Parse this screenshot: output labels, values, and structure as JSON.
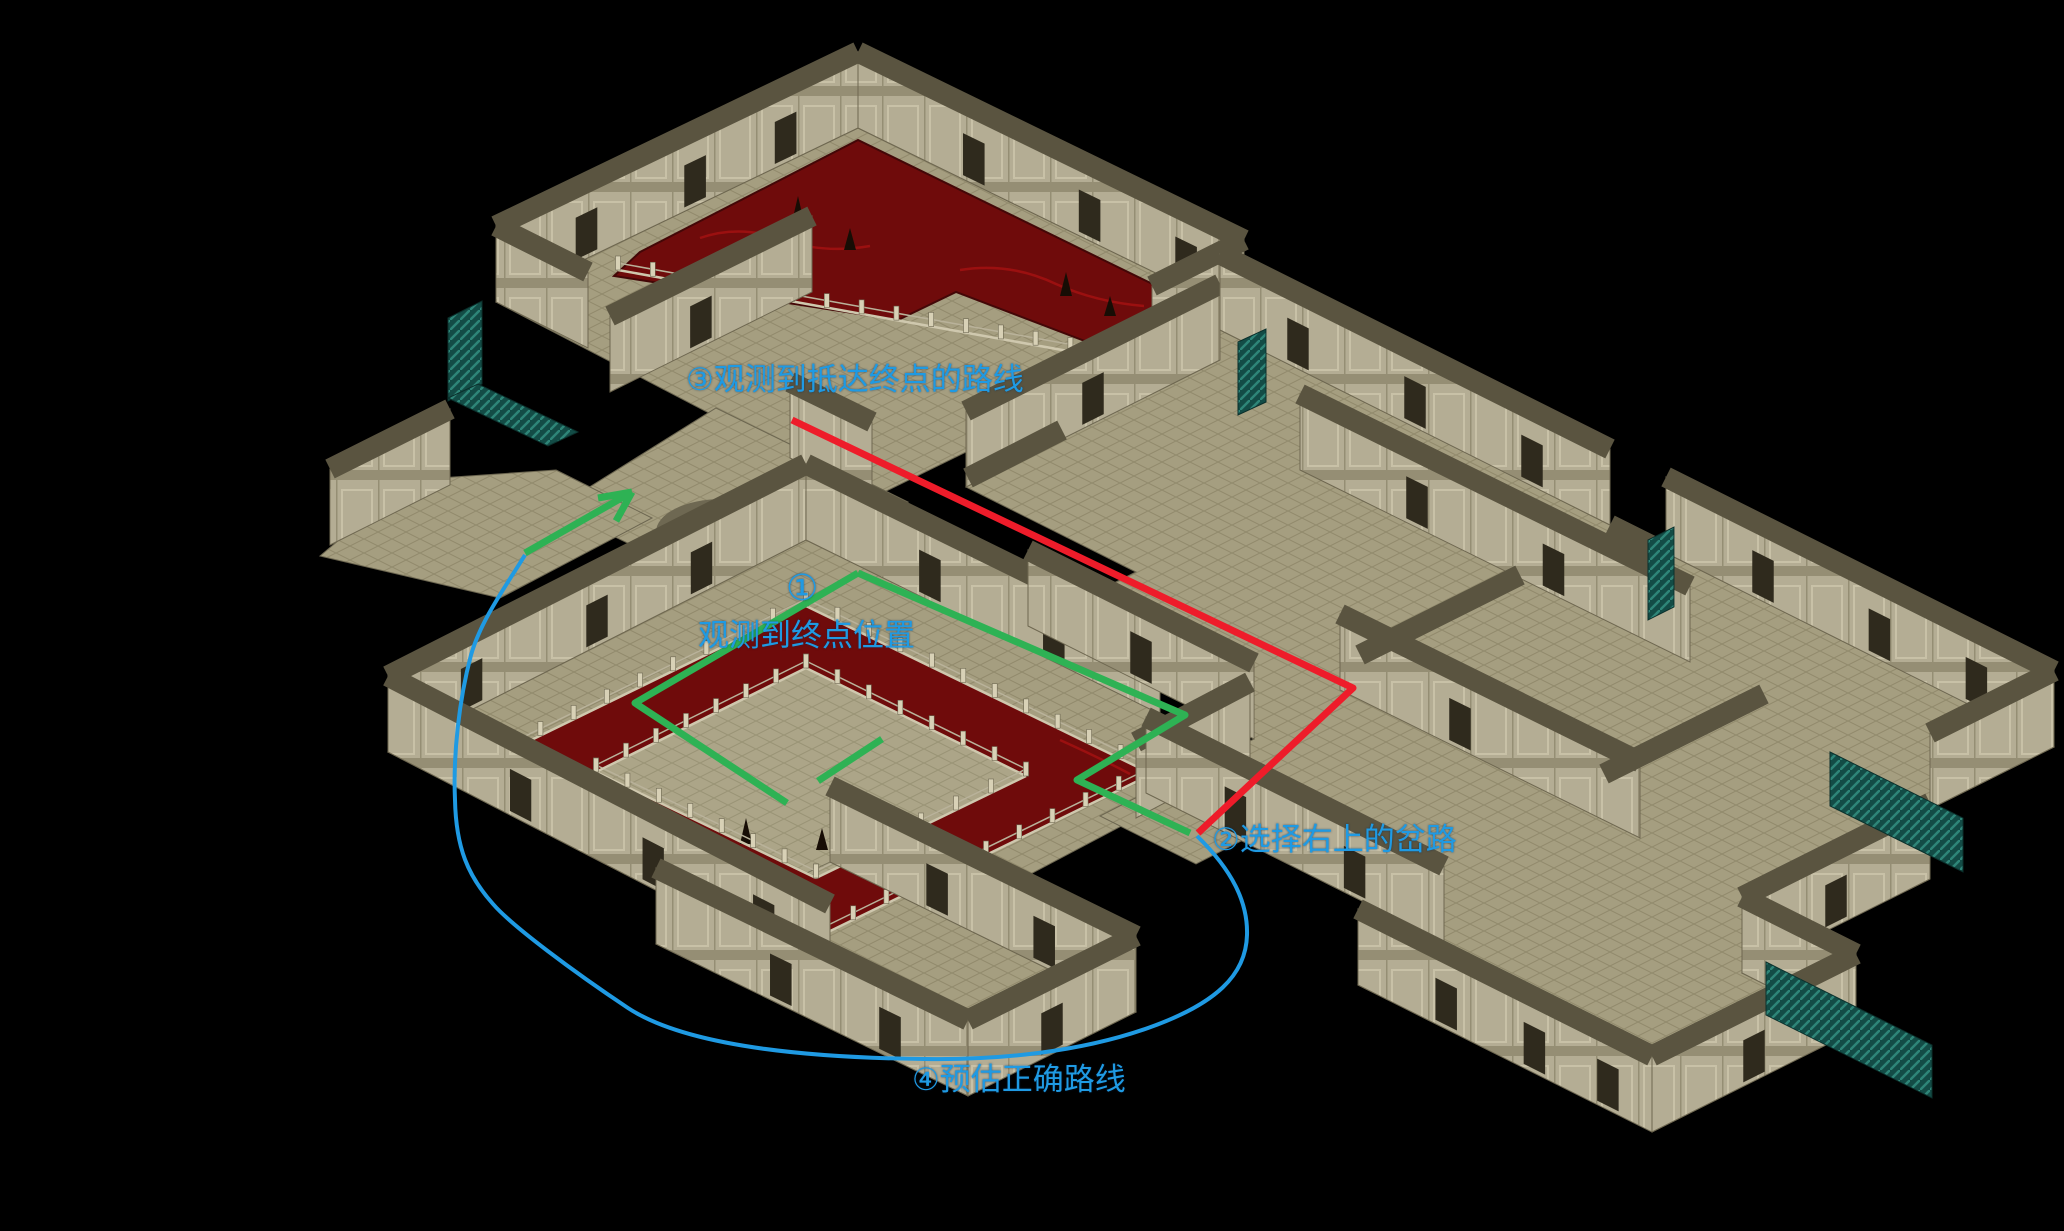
{
  "app": {
    "title": "isometric dungeon map with route annotations"
  },
  "annotations": {
    "text_color": "#1f9ae3",
    "labels": [
      {
        "id": "step3",
        "text": "③观测到抵达终点的路线",
        "x": 686,
        "y": 364,
        "size": 31
      },
      {
        "id": "step1_num",
        "text": "①",
        "x": 786,
        "y": 570,
        "size": 36
      },
      {
        "id": "step1",
        "text": "观测到终点位置",
        "x": 698,
        "y": 620,
        "size": 31
      },
      {
        "id": "step2",
        "text": "②选择右上的岔路",
        "x": 1212,
        "y": 824,
        "size": 31
      },
      {
        "id": "step4",
        "text": "④预估正确路线",
        "x": 912,
        "y": 1064,
        "size": 31
      }
    ],
    "red_route": {
      "color": "#ee1c2a",
      "width": 7,
      "points": [
        [
          792,
          420
        ],
        [
          1353,
          688
        ],
        [
          1198,
          833
        ]
      ]
    },
    "green_route": {
      "color": "#2eb254",
      "width": 7,
      "segments": [
        [
          [
            858,
            573
          ],
          [
            1185,
            715
          ],
          [
            1077,
            780
          ],
          [
            1190,
            833
          ]
        ],
        [
          [
            858,
            573
          ],
          [
            635,
            703
          ],
          [
            787,
            803
          ]
        ],
        [
          [
            882,
            739
          ],
          [
            818,
            781
          ]
        ],
        [
          [
            525,
            553
          ],
          [
            625,
            496
          ]
        ],
        [
          [
            632,
            492
          ],
          [
            598,
            498
          ]
        ],
        [
          [
            632,
            492
          ],
          [
            616,
            521
          ]
        ]
      ]
    },
    "blue_route": {
      "color": "#1f9ae3",
      "width": 4,
      "path": "M1197,836 C1232,870 1248,902 1247,935 C1246,975 1216,1004 1148,1028 C1080,1052 1000,1060 925,1059 C830,1058 692,1050 628,1008 C574,972 512,926 493,904 C468,876 456,848 455,800 C453,755 459,700 471,655 C481,620 506,586 525,555"
    }
  },
  "scene": {
    "colors": {
      "bg": "#000000",
      "floor": "#a59e80",
      "grid": "#918a6c",
      "wall_face": "#b4ad94",
      "wall_top": "#5a5440",
      "panel_light": "#c8c1a7",
      "panel_dark": "#958e74",
      "door": "#2f2a1d",
      "pool": "#6f0b0b",
      "pool_swirl": "#a31212",
      "pool_edge": "#430707",
      "teal": "#134c46",
      "teal_stripe": "#2e8578",
      "rail": "#cfc8ae",
      "post": "#d8d1b6",
      "post_edge": "#6e6852",
      "spike": "#170d05",
      "yin_dark": "#6e6852",
      "yin_light": "#c9c3ab"
    },
    "wall_height": 76,
    "floors": [
      {
        "pts": [
          [
            858,
            128
          ],
          [
            1244,
            316
          ],
          [
            872,
            498
          ],
          [
            496,
            302
          ]
        ]
      },
      {
        "pts": [
          [
            716,
            408
          ],
          [
            908,
            502
          ],
          [
            748,
            602
          ],
          [
            556,
            508
          ]
        ]
      },
      {
        "pts": [
          [
            556,
            470
          ],
          [
            652,
            518
          ],
          [
            500,
            598
          ],
          [
            320,
            556
          ],
          [
            410,
            480
          ]
        ]
      },
      {
        "pts": [
          [
            806,
            540
          ],
          [
            1250,
            758
          ],
          [
            830,
            980
          ],
          [
            388,
            752
          ]
        ]
      },
      {
        "pts": [
          [
            1194,
            768
          ],
          [
            1290,
            816
          ],
          [
            1196,
            864
          ],
          [
            1100,
            816
          ]
        ]
      },
      {
        "pts": [
          [
            830,
            862
          ],
          [
            1136,
            1012
          ],
          [
            968,
            1096
          ],
          [
            656,
            944
          ]
        ]
      },
      {
        "pts": [
          [
            1220,
            330
          ],
          [
            1610,
            525
          ],
          [
            1666,
            553
          ],
          [
            2054,
            747
          ],
          [
            1930,
            809
          ],
          [
            1930,
            879
          ],
          [
            1742,
            973
          ],
          [
            1856,
            1030
          ],
          [
            1652,
            1132
          ],
          [
            1358,
            985
          ],
          [
            1444,
            942
          ],
          [
            1146,
            793
          ],
          [
            1254,
            739
          ],
          [
            1028,
            626
          ],
          [
            1136,
            572
          ],
          [
            966,
            487
          ],
          [
            1220,
            360
          ]
        ]
      }
    ],
    "floor_overlays": [
      {
        "pts": [
          [
            806,
            668
          ],
          [
            1026,
            776
          ],
          [
            816,
            878
          ],
          [
            596,
            772
          ]
        ],
        "fill": "rgba(238,232,205,0.10)"
      }
    ],
    "pools": [
      {
        "d": "M640,252 L858,140 L1226,320 L1140,362 L956,292 L898,320 L614,276 Z"
      },
      {
        "d": "M806,606 L1152,774 L820,936 L474,768 Z M806,668 L1026,776 L816,878 L596,772 Z"
      }
    ],
    "pool_swirls": [
      "M700,238 q40,-14 84,2 q40,14 86,6",
      "M960,270 q50,-8 96,14 q40,18 88,22",
      "M520,760 q60,26 120,40",
      "M880,880 q60,10 120,-14",
      "M1060,740 q40,18 70,34"
    ],
    "spikes": [
      [
        798,
        222,
        26
      ],
      [
        850,
        250,
        22
      ],
      [
        1066,
        296,
        24
      ],
      [
        1110,
        316,
        20
      ],
      [
        746,
        844,
        26
      ],
      [
        822,
        850,
        22
      ]
    ],
    "fences": [
      {
        "a": [
          618,
          270
        ],
        "b": [
          1140,
          364
        ]
      },
      {
        "a": [
          806,
          606
        ],
        "b": [
          1152,
          774
        ]
      },
      {
        "a": [
          1152,
          774
        ],
        "b": [
          820,
          936
        ]
      },
      {
        "a": [
          820,
          936
        ],
        "b": [
          474,
          768
        ]
      },
      {
        "a": [
          474,
          768
        ],
        "b": [
          806,
          606
        ]
      },
      {
        "a": [
          806,
          668
        ],
        "b": [
          1026,
          776
        ]
      },
      {
        "a": [
          1026,
          776
        ],
        "b": [
          816,
          878
        ]
      },
      {
        "a": [
          816,
          878
        ],
        "b": [
          596,
          772
        ]
      },
      {
        "a": [
          596,
          772
        ],
        "b": [
          806,
          668
        ]
      }
    ],
    "walls": [
      {
        "a": [
          496,
          302
        ],
        "b": [
          858,
          128
        ],
        "doors": [
          0.25,
          0.55,
          0.8
        ]
      },
      {
        "a": [
          858,
          128
        ],
        "b": [
          1244,
          316
        ],
        "doors": [
          0.3,
          0.6,
          0.85
        ]
      },
      {
        "a": [
          610,
          392
        ],
        "b": [
          812,
          292
        ],
        "doors": [
          0.45
        ]
      },
      {
        "a": [
          966,
          487
        ],
        "b": [
          1220,
          360
        ],
        "doors": [
          0.5
        ]
      },
      {
        "a": [
          1220,
          330
        ],
        "b": [
          1610,
          525
        ],
        "doors": [
          0.2,
          0.5,
          0.8
        ]
      },
      {
        "a": [
          1666,
          553
        ],
        "b": [
          2054,
          747
        ],
        "doors": [
          0.25,
          0.55,
          0.8
        ]
      },
      {
        "a": [
          388,
          752
        ],
        "b": [
          806,
          540
        ],
        "doors": [
          0.2,
          0.5,
          0.75
        ]
      },
      {
        "a": [
          806,
          540
        ],
        "b": [
          1160,
          714
        ],
        "doors": [
          0.35,
          0.7
        ]
      },
      {
        "a": [
          1028,
          626
        ],
        "b": [
          1254,
          739
        ],
        "doors": [
          0.5
        ]
      },
      {
        "a": [
          1300,
          470
        ],
        "b": [
          1690,
          662
        ],
        "doors": [
          0.3,
          0.65
        ]
      },
      {
        "a": [
          1340,
          690
        ],
        "b": [
          1640,
          838
        ],
        "doors": [
          0.4
        ]
      },
      {
        "a": [
          496,
          302
        ],
        "b": [
          588,
          348
        ],
        "doors": []
      },
      {
        "a": [
          790,
          458
        ],
        "b": [
          872,
          498
        ],
        "doors": []
      },
      {
        "a": [
          1244,
          316
        ],
        "b": [
          1152,
          362
        ],
        "doors": []
      },
      {
        "a": [
          330,
          545
        ],
        "b": [
          450,
          485
        ],
        "doors": []
      },
      {
        "a": [
          1146,
          793
        ],
        "b": [
          1444,
          942
        ],
        "doors": [
          0.3,
          0.7
        ]
      },
      {
        "a": [
          388,
          752
        ],
        "b": [
          830,
          980
        ],
        "doors": [
          0.3,
          0.6,
          0.85
        ]
      },
      {
        "a": [
          1136,
          818
        ],
        "b": [
          1250,
          758
        ],
        "doors": []
      },
      {
        "a": [
          830,
          862
        ],
        "b": [
          1136,
          1012
        ],
        "doors": [
          0.35,
          0.7
        ]
      },
      {
        "a": [
          656,
          944
        ],
        "b": [
          968,
          1096
        ],
        "doors": [
          0.4,
          0.75
        ]
      },
      {
        "a": [
          1136,
          1012
        ],
        "b": [
          968,
          1096
        ],
        "doors": [
          0.5
        ]
      },
      {
        "a": [
          1930,
          879
        ],
        "b": [
          1742,
          973
        ],
        "doors": [
          0.5
        ]
      },
      {
        "a": [
          2054,
          747
        ],
        "b": [
          1930,
          809
        ],
        "doors": []
      },
      {
        "a": [
          1358,
          985
        ],
        "b": [
          1652,
          1132
        ],
        "doors": [
          0.3,
          0.6,
          0.85
        ]
      },
      {
        "a": [
          1742,
          973
        ],
        "b": [
          1856,
          1030
        ],
        "doors": []
      },
      {
        "a": [
          1652,
          1132
        ],
        "b": [
          1856,
          1030
        ],
        "doors": [
          0.5
        ]
      }
    ],
    "rooflines": [
      [
        [
          1520,
          575
        ],
        [
          1360,
          655
        ]
      ],
      [
        [
          1764,
          694
        ],
        [
          1604,
          774
        ]
      ],
      [
        [
          1610,
          525
        ],
        [
          1666,
          553
        ]
      ],
      [
        [
          1062,
          430
        ],
        [
          968,
          478
        ]
      ]
    ],
    "teal_pieces": [
      [
        [
          448,
          318
        ],
        [
          482,
          301
        ],
        [
          482,
          384
        ],
        [
          448,
          401
        ]
      ],
      [
        [
          448,
          398
        ],
        [
          548,
          446
        ],
        [
          578,
          432
        ],
        [
          478,
          384
        ]
      ],
      [
        [
          1238,
          342
        ],
        [
          1266,
          329
        ],
        [
          1266,
          402
        ],
        [
          1238,
          415
        ]
      ],
      [
        [
          1648,
          540
        ],
        [
          1674,
          527
        ],
        [
          1674,
          607
        ],
        [
          1648,
          620
        ]
      ],
      [
        [
          1830,
          752
        ],
        [
          1963,
          818
        ],
        [
          1963,
          872
        ],
        [
          1830,
          806
        ]
      ],
      [
        [
          1766,
          962
        ],
        [
          1932,
          1045
        ],
        [
          1932,
          1098
        ],
        [
          1766,
          1015
        ]
      ]
    ],
    "yinyang": {
      "cx": 722,
      "cy": 532,
      "rx": 66,
      "ry": 33
    }
  }
}
